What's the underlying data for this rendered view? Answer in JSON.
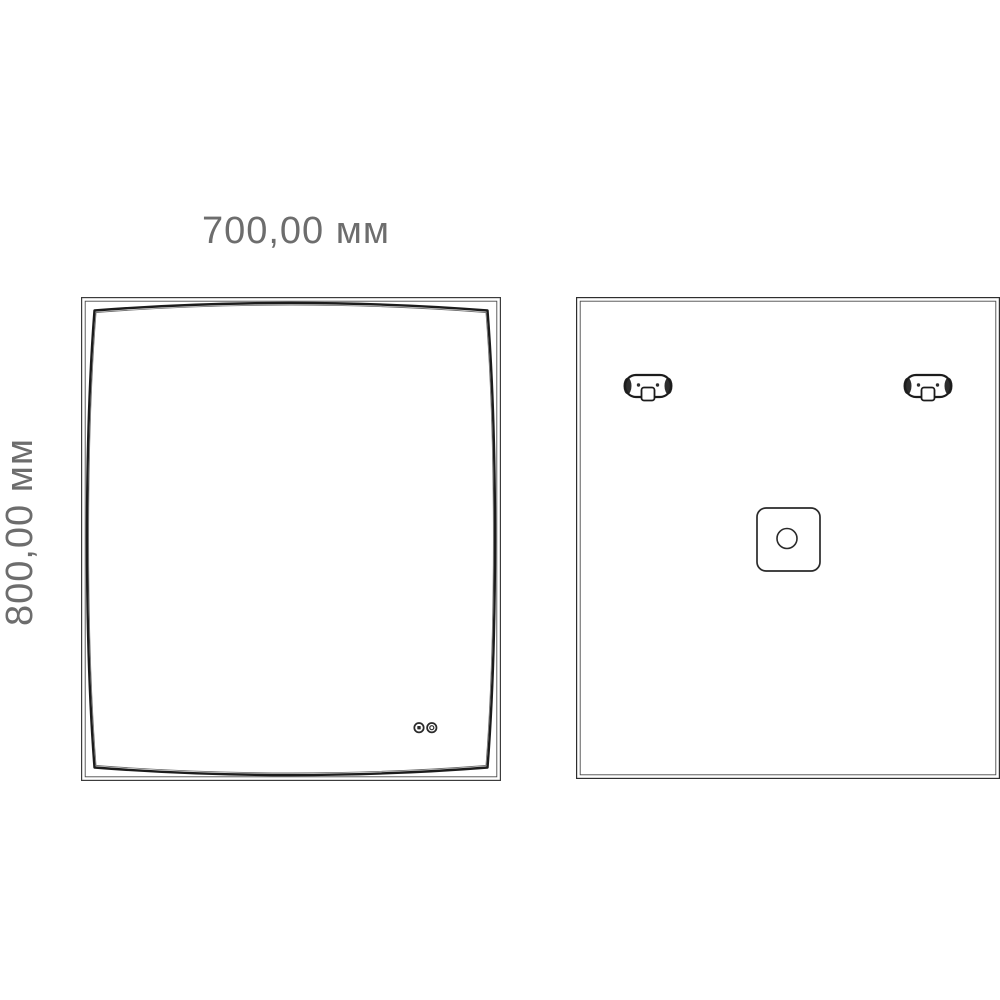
{
  "drawing": {
    "type": "technical-dimension-drawing",
    "subject": "led-mirror",
    "background_color": "#ffffff",
    "line_color": "#222222",
    "thin_line_color": "#3c3c3c",
    "dim_text_color": "#6d6d6d",
    "dimensions": {
      "width_label": "700,00 мм",
      "height_label": "800,00 мм"
    },
    "views": {
      "front": {
        "icons": [
          "touch-button-1-icon",
          "touch-button-2-icon"
        ]
      },
      "back": {
        "icons": [
          "mounting-bracket-left",
          "mounting-bracket-right",
          "junction-box",
          "cable-hole"
        ]
      }
    }
  }
}
